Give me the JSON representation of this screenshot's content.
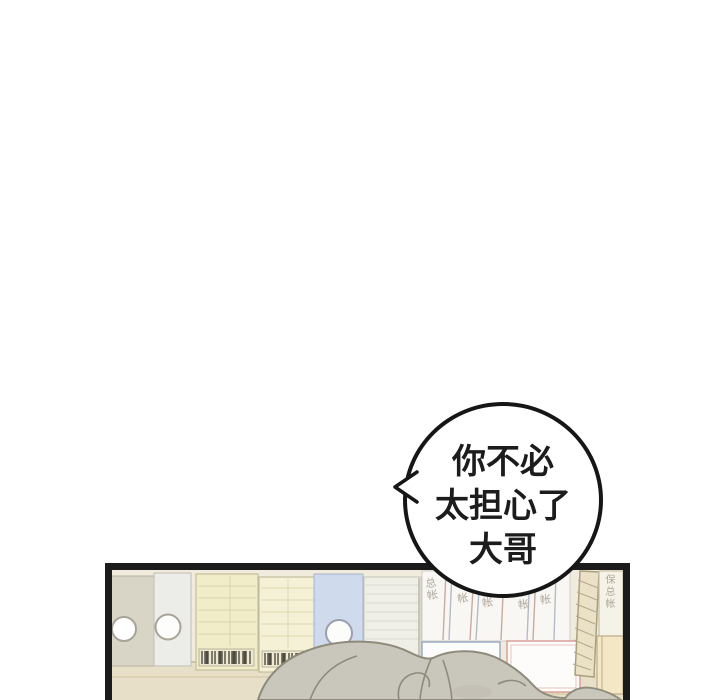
{
  "bubble": {
    "lines": [
      "你不必",
      "太担心了",
      "大哥"
    ]
  },
  "shelf": {
    "spine_labels": [
      "总帐",
      "帐",
      "帐",
      "帐",
      "帐",
      "保总帐"
    ]
  },
  "colors": {
    "page_background": "#ffffff",
    "outline_black": "#161616",
    "panel_border": "#1b1b1b",
    "panel_background": "#f0ebdc",
    "ledger_yellow": "#f2edc9",
    "binder_gray": "#d8d4c6",
    "binder_blue": "#cfdaec",
    "book_white": "#f8f7f3",
    "box_outline_pink": "#d99f99",
    "box_outline_blue": "#9dabc2",
    "hair_gray": "#c9c6bb",
    "hair_outline": "#8e8b7d",
    "shelf_beige": "#e8dfc8",
    "spine_label_gray": "#b0a79c"
  }
}
